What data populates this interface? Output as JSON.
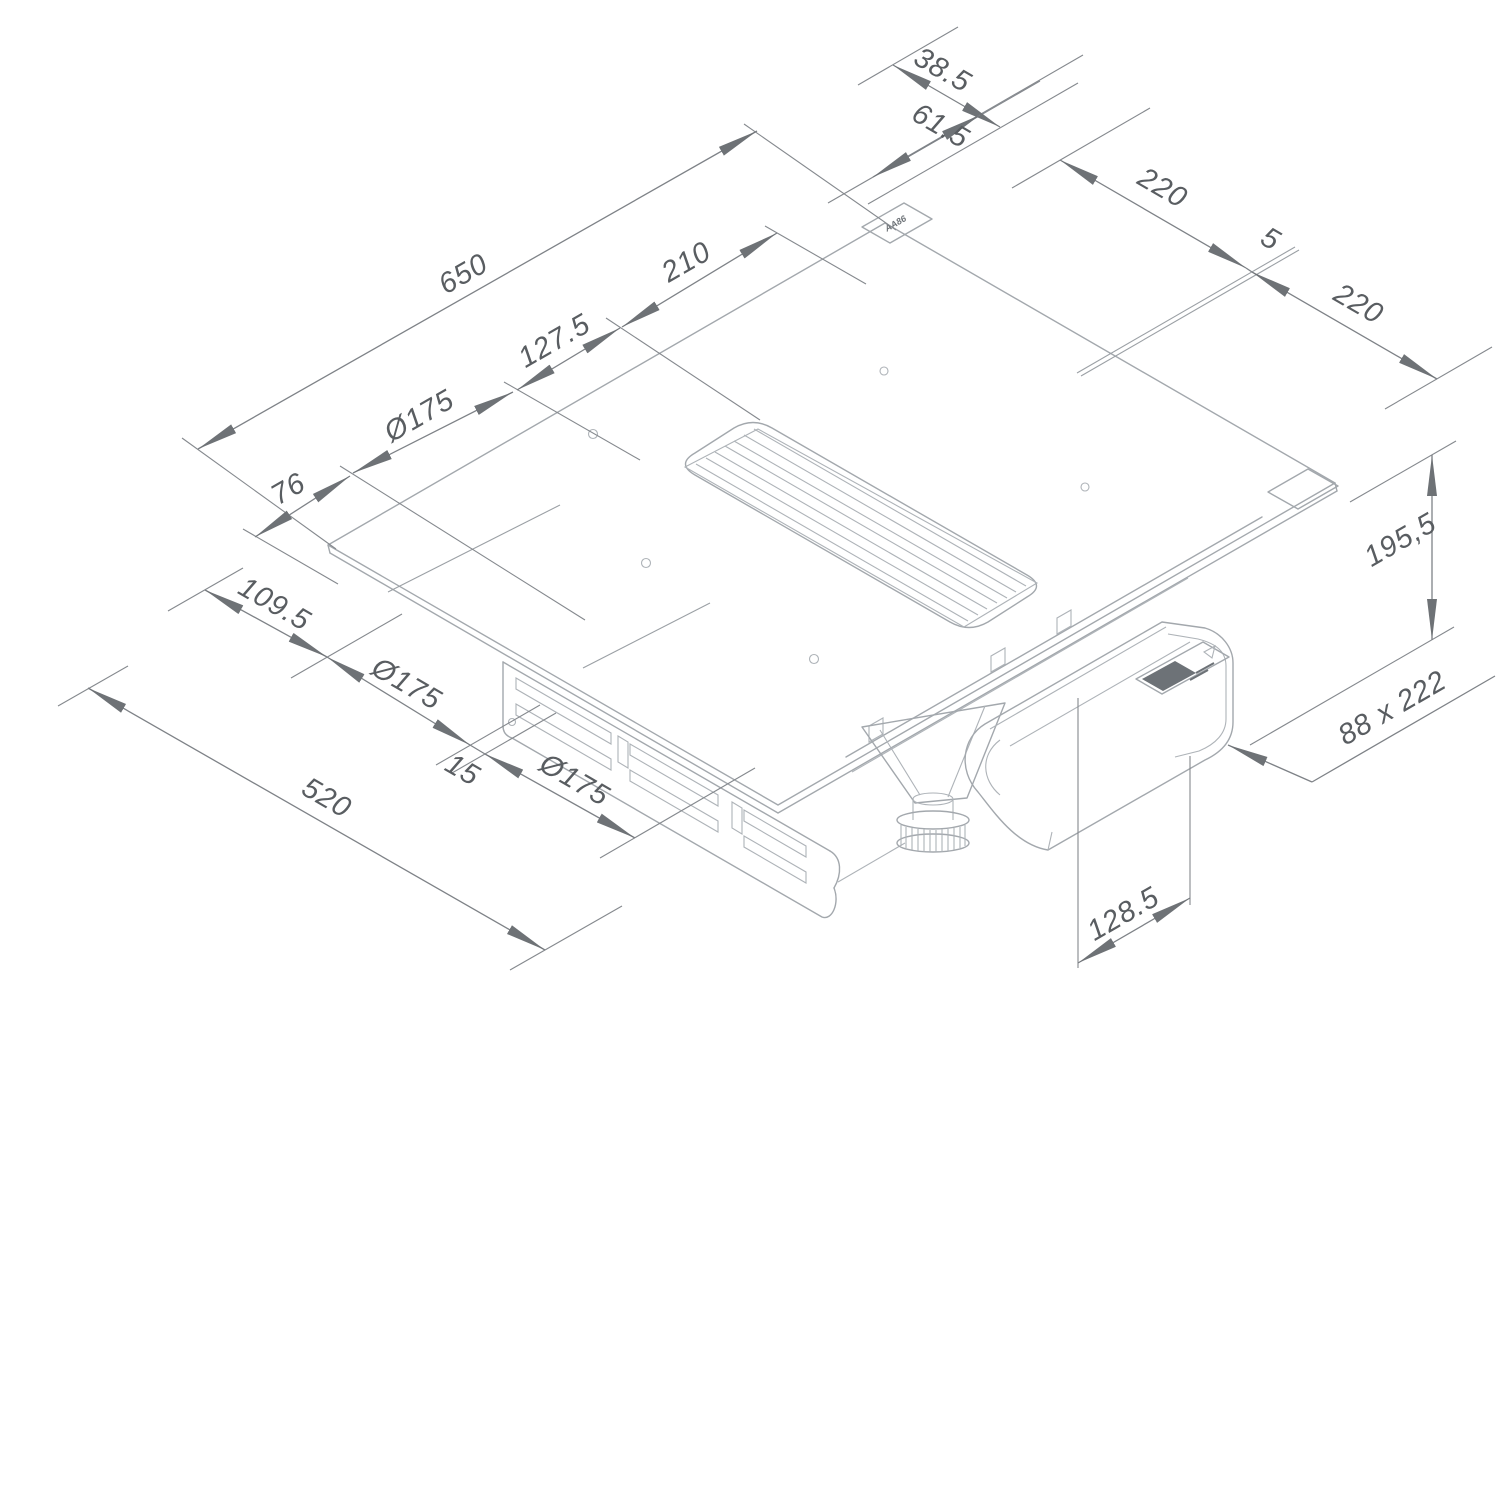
{
  "page": {
    "background": "#ffffff"
  },
  "palette": {
    "object_line": "#a3a8ad",
    "dimension_line": "#7e8287",
    "arrow_fill": "#6e7276",
    "text_color": "#595d61",
    "label_block": "#6d7277"
  },
  "parts": [
    "glass-top",
    "air-intake-grille",
    "cooking-zone-markers",
    "flex-zone-split-line",
    "control-window",
    "chassis-vent-slots",
    "blower-unit",
    "adjustable-foot",
    "flat-duct",
    "rating-label"
  ],
  "dimensions": {
    "rear_left_chain": {
      "total_width": "650",
      "grille_offset": "210",
      "zone_offset": "127.5",
      "rear_zone_diameter": "Ø175",
      "edge_margin": "76"
    },
    "rear_marking_chain": {
      "outer": "38.5",
      "inner": "61.5"
    },
    "right_flex_chain": {
      "rear_zone": "220",
      "gap": "5",
      "front_zone": "220"
    },
    "height_total": "195,5",
    "duct_section": "88 x 222",
    "duct_offset": "128.5",
    "front_left_chain": {
      "rear_margin": "109.5",
      "zone_a_diameter": "Ø175",
      "zone_gap": "15",
      "zone_b_diameter": "Ø175",
      "total_depth": "520"
    },
    "glass_microlabel": "AA86"
  }
}
